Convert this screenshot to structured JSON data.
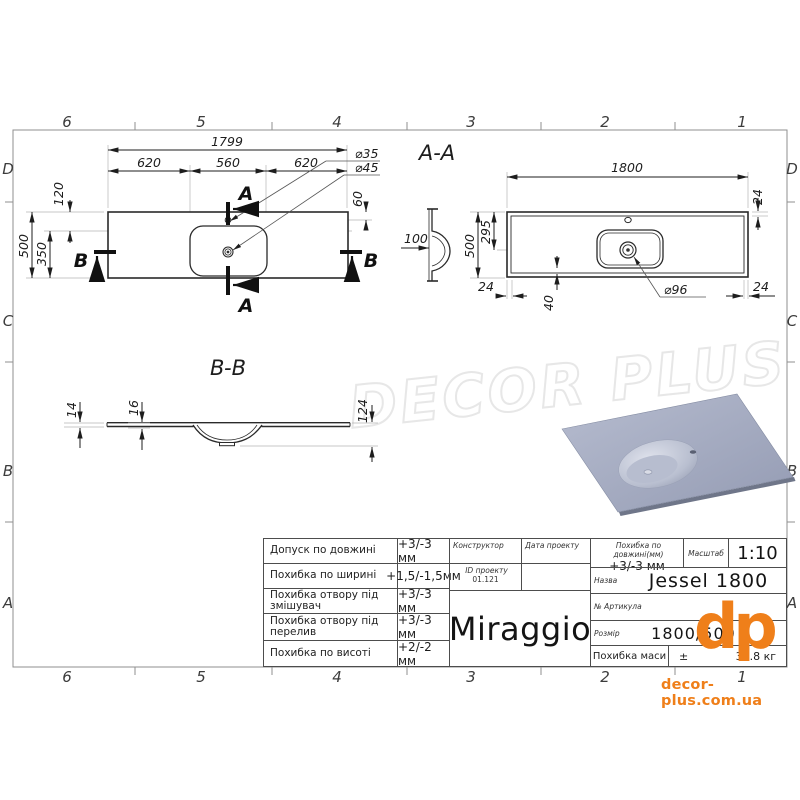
{
  "sheet": {
    "cols": [
      "6",
      "5",
      "4",
      "3",
      "2",
      "1"
    ],
    "rows": [
      "D",
      "C",
      "B",
      "A"
    ]
  },
  "watermark": "DECOR PLUS",
  "brand_footer": {
    "logo": "dp",
    "url": "decor-plus.com.ua"
  },
  "top_view": {
    "len": "1799",
    "seg1": "620",
    "seg2": "560",
    "seg3": "620",
    "d_faucet": "⌀35",
    "d_drain": "⌀45",
    "off_top": "120",
    "height": "500",
    "off_basin": "350",
    "off_faucet": "60",
    "sec_a": "A",
    "sec_b": "B"
  },
  "section_aa": {
    "title": "A-A",
    "len": "1800",
    "t_top": "24",
    "height": "500",
    "h_drain": "295",
    "depth": "100",
    "t_left": "24",
    "off_drain": "40",
    "d_drain": "⌀96",
    "t_right": "24"
  },
  "section_bb": {
    "title": "B-B",
    "t_slab": "14",
    "t_edge": "16",
    "depth": "124"
  },
  "title_block": {
    "rows": [
      {
        "label": "Допуск по довжині",
        "value": "+3/-3 мм"
      },
      {
        "label": "Похибка по ширині",
        "value": "+1,5/-1,5мм"
      },
      {
        "label": "Похибка отвору під змішувач",
        "value": "+3/-3 мм"
      },
      {
        "label": "Похибка отвору під перелив",
        "value": "+3/-3 мм"
      },
      {
        "label": "Похибка по висоті",
        "value": "+2/-2 мм"
      }
    ],
    "constructor_label": "Конструктор",
    "date_label": "Дата проекту",
    "project_id_label": "ID проекту",
    "project_id": "01.121",
    "brand": "Miraggio",
    "len_tol_label": "Похибка по довжині(мм)",
    "len_tol_value": "+3/-3 мм",
    "scale_label": "Масштаб",
    "scale_value": "1:10",
    "name_label": "Назва",
    "name_value": "Jessel 1800",
    "article_label": "№ Артикула",
    "size_label": "Розмір",
    "size_value": "1800/500",
    "mass_label": "Похибка маси",
    "mass_prefix": "±",
    "mass_value": "31.8 кг"
  },
  "colors": {
    "accent": "#ef7f1a",
    "line": "#2a2a2a",
    "frame": "#8f8f8f",
    "model": "#a9b0c6"
  }
}
